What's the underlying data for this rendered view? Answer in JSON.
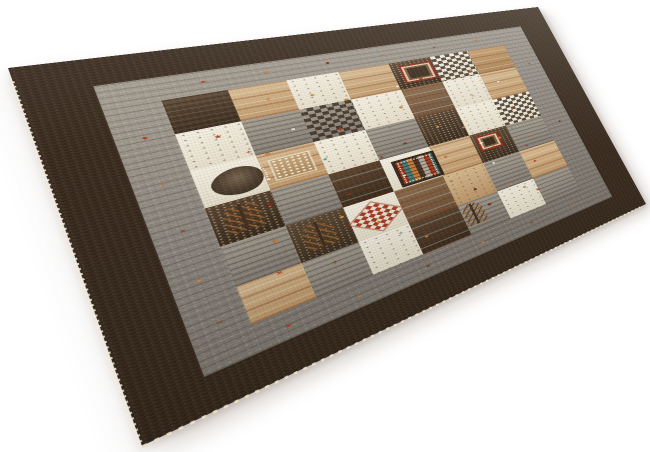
{
  "meta": {
    "description": "Product photograph of a square Gabbeh-style patchwork wool rug lying on a plain white background, viewed at a perspective angle",
    "scene": "white seamless backdrop, soft shadow under lower edges, fringe dots along near-left edge"
  },
  "canvas": {
    "w": 650,
    "h": 452,
    "background": "#ffffff"
  },
  "rug": {
    "flat_size": 600,
    "corners": {
      "tl": [
        8,
        68
      ],
      "tr": [
        538,
        7
      ],
      "br": [
        646,
        204
      ],
      "bl": [
        142,
        446
      ]
    },
    "palette": {
      "border_dark": "#38291c",
      "border_dark_light": "#5d4834",
      "border_dark_deep": "#2c2015",
      "border_gray": "#8f8981",
      "border_gray_light": "#a59d90",
      "cream": "#ece5d3",
      "tan": "#c79e6e",
      "camel": "#b98a55",
      "brown": "#7a5c40",
      "dark_patch": "#3e2e21",
      "gray_patch": "#8e8a83",
      "accent_rust": "#b23b1d",
      "accent_red": "#8e2012",
      "accent_orange": "#d2803a",
      "accent_teal": "#5e938f",
      "accent_white": "#f2ecdf",
      "accent_gold": "#c9973f",
      "fringe": "#f4ecda"
    },
    "borders": {
      "outer_pct": 8.5,
      "gray_pct": 7.5
    },
    "field": {
      "cells": [
        {
          "x": 0,
          "y": 0,
          "w": 14,
          "h": 16,
          "c": "dark",
          "p": "striate"
        },
        {
          "x": 14,
          "y": 0,
          "w": 14,
          "h": 16,
          "c": "tan",
          "p": "stripes"
        },
        {
          "x": 28,
          "y": 0,
          "w": 14,
          "h": 16,
          "c": "cream",
          "p": "sparse"
        },
        {
          "x": 42,
          "y": 0,
          "w": 15,
          "h": 16,
          "c": "tan",
          "p": "stripes"
        },
        {
          "x": 57,
          "y": 0,
          "w": 14,
          "h": 16,
          "c": "dark",
          "p": "speck"
        },
        {
          "x": 71,
          "y": 0,
          "w": 14,
          "h": 16,
          "c": "cream",
          "p": "grid"
        },
        {
          "x": 85,
          "y": 0,
          "w": 15,
          "h": 16,
          "c": "camel",
          "p": "stripes"
        },
        {
          "x": 0,
          "y": 16,
          "w": 14,
          "h": 17,
          "c": "cream",
          "p": "sparse"
        },
        {
          "x": 14,
          "y": 16,
          "w": 14,
          "h": 17,
          "c": "gray",
          "p": "striate"
        },
        {
          "x": 28,
          "y": 16,
          "w": 14,
          "h": 17,
          "c": "gray",
          "p": "grid"
        },
        {
          "x": 42,
          "y": 16,
          "w": 15,
          "h": 17,
          "c": "cream",
          "p": "sparse"
        },
        {
          "x": 57,
          "y": 16,
          "w": 14,
          "h": 17,
          "c": "brown",
          "p": "stripes"
        },
        {
          "x": 71,
          "y": 16,
          "w": 14,
          "h": 17,
          "c": "cream",
          "p": "sparse"
        },
        {
          "x": 85,
          "y": 16,
          "w": 15,
          "h": 17,
          "c": "tan",
          "p": "stripes"
        },
        {
          "x": 0,
          "y": 33,
          "w": 14,
          "h": 17,
          "c": "cream",
          "p": ""
        },
        {
          "x": 14,
          "y": 33,
          "w": 14,
          "h": 17,
          "c": "tan",
          "p": "stripes"
        },
        {
          "x": 28,
          "y": 33,
          "w": 14,
          "h": 17,
          "c": "cream",
          "p": "sparse"
        },
        {
          "x": 42,
          "y": 33,
          "w": 15,
          "h": 17,
          "c": "gray",
          "p": "striate"
        },
        {
          "x": 57,
          "y": 33,
          "w": 14,
          "h": 17,
          "c": "dark",
          "p": "speck"
        },
        {
          "x": 71,
          "y": 33,
          "w": 14,
          "h": 17,
          "c": "cream",
          "p": "sparse"
        },
        {
          "x": 85,
          "y": 33,
          "w": 15,
          "h": 17,
          "c": "cream",
          "p": "grid"
        },
        {
          "x": 0,
          "y": 50,
          "w": 14,
          "h": 17,
          "c": "dark",
          "p": "speck"
        },
        {
          "x": 14,
          "y": 50,
          "w": 14,
          "h": 17,
          "c": "gray",
          "p": "striate"
        },
        {
          "x": 28,
          "y": 50,
          "w": 14,
          "h": 17,
          "c": "dark",
          "p": "stripes"
        },
        {
          "x": 42,
          "y": 50,
          "w": 15,
          "h": 17,
          "c": "cream",
          "p": ""
        },
        {
          "x": 57,
          "y": 50,
          "w": 14,
          "h": 17,
          "c": "tan",
          "p": "stripes"
        },
        {
          "x": 71,
          "y": 50,
          "w": 14,
          "h": 17,
          "c": "dark",
          "p": "speck"
        },
        {
          "x": 85,
          "y": 50,
          "w": 15,
          "h": 17,
          "c": "gray",
          "p": "striate"
        },
        {
          "x": 0,
          "y": 67,
          "w": 14,
          "h": 17,
          "c": "gray",
          "p": "striate"
        },
        {
          "x": 14,
          "y": 67,
          "w": 14,
          "h": 17,
          "c": "dark",
          "p": "speck"
        },
        {
          "x": 28,
          "y": 67,
          "w": 14,
          "h": 17,
          "c": "cream",
          "p": ""
        },
        {
          "x": 42,
          "y": 67,
          "w": 15,
          "h": 17,
          "c": "brown",
          "p": "stripes"
        },
        {
          "x": 57,
          "y": 67,
          "w": 14,
          "h": 17,
          "c": "tan",
          "p": "sparse"
        },
        {
          "x": 71,
          "y": 67,
          "w": 14,
          "h": 17,
          "c": "gray",
          "p": "striate"
        },
        {
          "x": 85,
          "y": 67,
          "w": 15,
          "h": 17,
          "c": "tan",
          "p": "stripes"
        },
        {
          "x": 0,
          "y": 84,
          "w": 14,
          "h": 16,
          "c": "tan",
          "p": "stripes"
        },
        {
          "x": 14,
          "y": 84,
          "w": 14,
          "h": 16,
          "c": "gray",
          "p": "striate"
        },
        {
          "x": 28,
          "y": 84,
          "w": 14,
          "h": 16,
          "c": "cream",
          "p": "sparse"
        },
        {
          "x": 42,
          "y": 84,
          "w": 15,
          "h": 16,
          "c": "dark",
          "p": "stripes"
        },
        {
          "x": 57,
          "y": 84,
          "w": 14,
          "h": 16,
          "c": "gray",
          "p": "striate"
        },
        {
          "x": 71,
          "y": 84,
          "w": 14,
          "h": 16,
          "c": "cream",
          "p": "sparse"
        },
        {
          "x": 85,
          "y": 84,
          "w": 15,
          "h": 16,
          "c": "gray",
          "p": "striate"
        }
      ],
      "specials": [
        {
          "t": "leaf",
          "x": 3,
          "y": 36,
          "w": 11,
          "h": 12
        },
        {
          "t": "lattice",
          "x": 16.5,
          "y": 37,
          "w": 9,
          "h": 9
        },
        {
          "t": "mosaic",
          "x": 44.5,
          "y": 52.5,
          "w": 11.5,
          "h": 12
        },
        {
          "t": "checker",
          "x": 30,
          "y": 70.5,
          "w": 10,
          "h": 10
        },
        {
          "t": "medallion",
          "x": 59.5,
          "y": 2.5,
          "w": 9.5,
          "h": 9
        },
        {
          "t": "medallion",
          "x": 72.5,
          "y": 52,
          "w": 7,
          "h": 7
        },
        {
          "t": "tree",
          "x": 2.5,
          "y": 52,
          "w": 8,
          "h": 12
        },
        {
          "t": "tree",
          "x": 16.5,
          "y": 69,
          "w": 7.5,
          "h": 12
        },
        {
          "t": "tree",
          "x": 57.5,
          "y": 85,
          "w": 7,
          "h": 11
        }
      ],
      "glyphs": [
        {
          "g": "★",
          "c": "#b23b1d",
          "x": 7,
          "y": 20,
          "s": 9
        },
        {
          "g": "+",
          "c": "#d2803a",
          "x": 21,
          "y": 7,
          "s": 9
        },
        {
          "g": "◆",
          "c": "#a93a20",
          "x": 35,
          "y": 29,
          "s": 8
        },
        {
          "g": "★",
          "c": "#8e2012",
          "x": 50,
          "y": 44,
          "s": 8
        },
        {
          "g": "◆",
          "c": "#b23b1d",
          "x": 64,
          "y": 11,
          "s": 8
        },
        {
          "g": "+",
          "c": "#c9973f",
          "x": 78,
          "y": 27,
          "s": 9
        },
        {
          "g": "★",
          "c": "#b23b1d",
          "x": 90,
          "y": 40,
          "s": 8
        },
        {
          "g": "◆",
          "c": "#8e2012",
          "x": 12,
          "y": 55,
          "s": 8
        },
        {
          "g": "+",
          "c": "#b23b1d",
          "x": 30,
          "y": 61,
          "s": 9
        },
        {
          "g": "★",
          "c": "#d2803a",
          "x": 58,
          "y": 70,
          "s": 8
        },
        {
          "g": "◆",
          "c": "#efe8d7",
          "x": 73,
          "y": 55,
          "s": 8
        },
        {
          "g": "◆",
          "c": "#b23b1d",
          "x": 76.5,
          "y": 59,
          "s": 8
        },
        {
          "g": "◆",
          "c": "#d2803a",
          "x": 80,
          "y": 55,
          "s": 8
        },
        {
          "g": "★",
          "c": "#b23b1d",
          "x": 88,
          "y": 74,
          "s": 8
        },
        {
          "g": "+",
          "c": "#a93a20",
          "x": 20,
          "y": 88,
          "s": 9
        },
        {
          "g": "★",
          "c": "#d2803a",
          "x": 44,
          "y": 92,
          "s": 8
        },
        {
          "g": "◆",
          "c": "#8e2012",
          "x": 66,
          "y": 88,
          "s": 8
        },
        {
          "g": "★",
          "c": "#b23b1d",
          "x": 84,
          "y": 90,
          "s": 8
        },
        {
          "g": "●",
          "c": "#d2803a",
          "x": 16,
          "y": 33,
          "s": 6
        },
        {
          "g": "●",
          "c": "#cc7d36",
          "x": 40,
          "y": 15,
          "s": 6
        },
        {
          "g": "●",
          "c": "#d2803a",
          "x": 54,
          "y": 25,
          "s": 6
        },
        {
          "g": "●",
          "c": "#cc7d36",
          "x": 70,
          "y": 44,
          "s": 6
        },
        {
          "g": "●",
          "c": "#d2803a",
          "x": 82,
          "y": 12,
          "s": 6
        },
        {
          "g": "●",
          "c": "#cc7d36",
          "x": 10,
          "y": 71,
          "s": 6
        },
        {
          "g": "●",
          "c": "#d2803a",
          "x": 34,
          "y": 78,
          "s": 6
        },
        {
          "g": "●",
          "c": "#cc7d36",
          "x": 60,
          "y": 57,
          "s": 6
        },
        {
          "g": "●",
          "c": "#d2803a",
          "x": 76,
          "y": 82,
          "s": 6
        },
        {
          "g": "●",
          "c": "#cc7d36",
          "x": 92,
          "y": 60,
          "s": 6
        },
        {
          "g": "★",
          "c": "#5e938f",
          "x": 28,
          "y": 42,
          "s": 7
        },
        {
          "g": "+",
          "c": "#5e938f",
          "x": 48,
          "y": 34,
          "s": 8
        },
        {
          "g": "★",
          "c": "#5e938f",
          "x": 18,
          "y": 64,
          "s": 7
        },
        {
          "g": "+",
          "c": "#5e938f",
          "x": 68,
          "y": 26,
          "s": 8
        },
        {
          "g": "★",
          "c": "#5e938f",
          "x": 86,
          "y": 52,
          "s": 7
        },
        {
          "g": "+",
          "c": "#5e938f",
          "x": 38,
          "y": 86,
          "s": 8
        },
        {
          "g": "▪",
          "c": "#f2ecdf",
          "x": 24,
          "y": 24,
          "s": 7
        },
        {
          "g": "▪",
          "c": "#f2ecdf",
          "x": 56,
          "y": 13,
          "s": 7
        },
        {
          "g": "▪",
          "c": "#f2ecdf",
          "x": 74,
          "y": 68,
          "s": 7
        },
        {
          "g": "▪",
          "c": "#f2ecdf",
          "x": 14,
          "y": 44,
          "s": 7
        },
        {
          "g": "▪",
          "c": "#f2ecdf",
          "x": 46,
          "y": 60,
          "s": 7
        },
        {
          "g": "▪",
          "c": "#f2ecdf",
          "x": 90,
          "y": 22,
          "s": 7
        },
        {
          "g": "◆",
          "c": "#c9973f",
          "x": 32,
          "y": 9,
          "s": 7
        },
        {
          "g": "◆",
          "c": "#c9973f",
          "x": 62,
          "y": 40,
          "s": 7
        },
        {
          "g": "◆",
          "c": "#c9973f",
          "x": 80,
          "y": 86,
          "s": 7
        },
        {
          "g": "◆",
          "c": "#c9973f",
          "x": 26,
          "y": 70,
          "s": 7
        },
        {
          "g": "+",
          "c": "#8e2012",
          "x": 42,
          "y": 48,
          "s": 9
        },
        {
          "g": "+",
          "c": "#b23b1d",
          "x": 12,
          "y": 30,
          "s": 8
        },
        {
          "g": "+",
          "c": "#8e2012",
          "x": 70,
          "y": 13,
          "s": 8
        },
        {
          "g": "+",
          "c": "#b23b1d",
          "x": 52,
          "y": 82,
          "s": 8
        },
        {
          "g": "+",
          "c": "#8e2012",
          "x": 88,
          "y": 64,
          "s": 8
        },
        {
          "g": "▲",
          "c": "#4a3524",
          "x": 36,
          "y": 52,
          "s": 7
        },
        {
          "g": "▲",
          "c": "#4a3524",
          "x": 64,
          "y": 78,
          "s": 7
        },
        {
          "g": "×",
          "c": "#b23b1d",
          "x": 8,
          "y": 84,
          "s": 9
        }
      ]
    },
    "border_glyphs": [
      {
        "g": "★",
        "c": "#b23b1d",
        "x": 22,
        "y": 11.6,
        "s": 7
      },
      {
        "g": "●",
        "c": "#d2803a",
        "x": 32,
        "y": 11.8,
        "s": 5
      },
      {
        "g": "◆",
        "c": "#8e2012",
        "x": 43,
        "y": 11.7,
        "s": 6
      },
      {
        "g": "+",
        "c": "#cc7d36",
        "x": 54,
        "y": 11.6,
        "s": 7
      },
      {
        "g": "★",
        "c": "#a93a20",
        "x": 66,
        "y": 11.8,
        "s": 6
      },
      {
        "g": "●",
        "c": "#d2803a",
        "x": 77,
        "y": 11.6,
        "s": 5
      },
      {
        "g": "◆",
        "c": "#b23b1d",
        "x": 20,
        "y": 87.6,
        "s": 6
      },
      {
        "g": "+",
        "c": "#d2803a",
        "x": 31,
        "y": 87.9,
        "s": 7
      },
      {
        "g": "★",
        "c": "#8e2012",
        "x": 44,
        "y": 87.7,
        "s": 6
      },
      {
        "g": "●",
        "c": "#cc7d36",
        "x": 56,
        "y": 87.6,
        "s": 5
      },
      {
        "g": "◆",
        "c": "#a93a20",
        "x": 68,
        "y": 87.9,
        "s": 6
      },
      {
        "g": "★",
        "c": "#d2803a",
        "x": 80,
        "y": 87.6,
        "s": 6
      },
      {
        "g": "●",
        "c": "#b23b1d",
        "x": 11.8,
        "y": 26,
        "s": 5
      },
      {
        "g": "+",
        "c": "#cc7d36",
        "x": 11.6,
        "y": 40,
        "s": 7
      },
      {
        "g": "★",
        "c": "#a93a20",
        "x": 11.9,
        "y": 54,
        "s": 6
      },
      {
        "g": "◆",
        "c": "#d2803a",
        "x": 11.6,
        "y": 68,
        "s": 6
      },
      {
        "g": "×",
        "c": "#b23b1d",
        "x": 12,
        "y": 80,
        "s": 7
      },
      {
        "g": "+",
        "c": "#b23b1d",
        "x": 87.9,
        "y": 26,
        "s": 7
      },
      {
        "g": "●",
        "c": "#d2803a",
        "x": 87.6,
        "y": 40,
        "s": 5
      },
      {
        "g": "◆",
        "c": "#8e2012",
        "x": 87.8,
        "y": 54,
        "s": 6
      },
      {
        "g": "★",
        "c": "#cc7d36",
        "x": 87.7,
        "y": 68,
        "s": 6
      }
    ]
  }
}
